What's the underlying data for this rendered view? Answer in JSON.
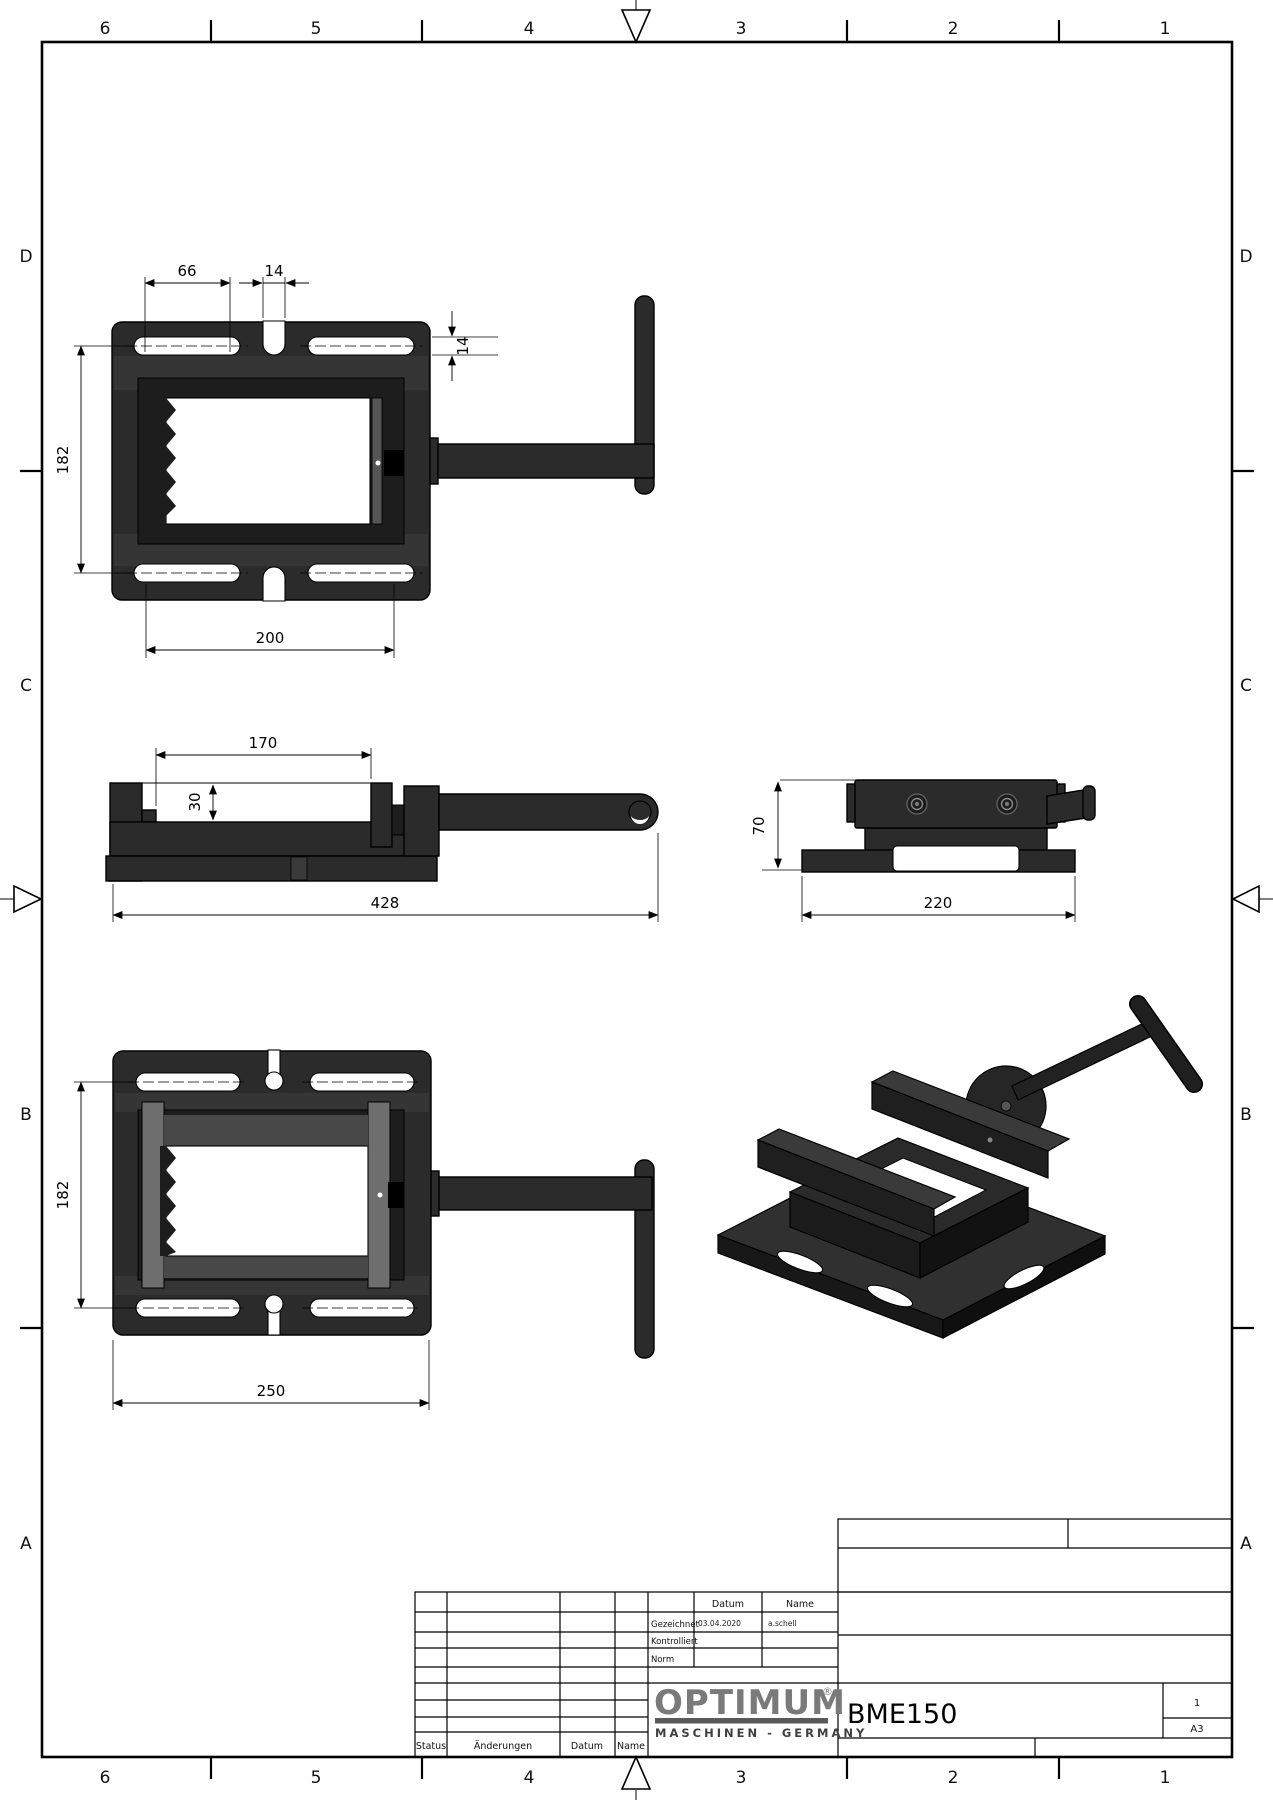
{
  "drawing": {
    "zones": {
      "top": [
        "6",
        "5",
        "4",
        "3",
        "2",
        "1"
      ],
      "bottom": [
        "6",
        "5",
        "4",
        "3",
        "2",
        "1"
      ],
      "left": [
        "D",
        "C",
        "B",
        "A"
      ],
      "right": [
        "D",
        "C",
        "B",
        "A"
      ]
    },
    "views": {
      "top_view": {
        "dim_66": "66",
        "dim_14_slot": "14",
        "dim_182": "182",
        "dim_14_depth": "14",
        "dim_200": "200"
      },
      "side_view": {
        "dim_170": "170",
        "dim_30": "30",
        "dim_428": "428"
      },
      "front_view": {
        "dim_70": "70",
        "dim_220": "220"
      },
      "bottom_view": {
        "dim_182": "182",
        "dim_250": "250"
      }
    },
    "title_block": {
      "revision": {
        "status": "Status",
        "aenderungen": "Änderungen",
        "datum": "Datum",
        "name": "Name"
      },
      "approval": {
        "datum_header": "Datum",
        "name_header": "Name",
        "rows": [
          {
            "label": "Gezeichnet",
            "datum": "03.04.2020",
            "name": "a.schell"
          },
          {
            "label": "Kontrolliert",
            "datum": "",
            "name": ""
          },
          {
            "label": "Norm",
            "datum": "",
            "name": ""
          }
        ]
      },
      "logo": {
        "brand": "OPTIMUM",
        "registered": "®",
        "subtitle": "MASCHINEN - GERMANY"
      },
      "part_number": "BME150",
      "sheet": "1",
      "format": "A3"
    },
    "colors": {
      "body": "#2b2b2b",
      "body_dark": "#1d1d1d",
      "rail": "#6e6e6e",
      "logo_gray": "#7a7a7a",
      "line": "#000000"
    }
  }
}
